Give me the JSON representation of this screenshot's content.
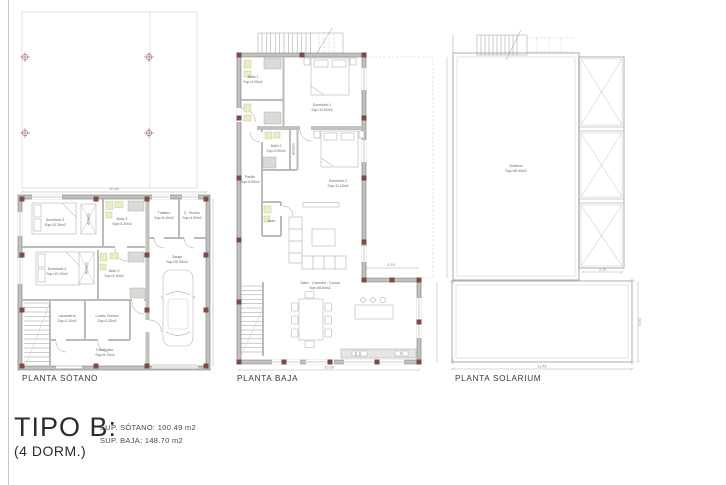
{
  "colors": {
    "wall_fill": "#c3c1bf",
    "wall_edge": "#7a7876",
    "column_block": "#7d4a45",
    "fixture_highlight": "#e9eec9",
    "shower_gray": "#dcdad7",
    "background": "#ffffff"
  },
  "title_block": {
    "type_label": "TIPO B:",
    "dorm_label": "(4 DORM.)",
    "sup_sotano": "SUP. SÓTANO: 100.49 m2",
    "sup_baja": "SUP. BAJA: 148.70 m2"
  },
  "plans": {
    "sotano": {
      "label": "PLANTA SÓTANO",
      "dims": {
        "width": "10.50"
      },
      "rooms": {
        "dorm3": {
          "name": "Dormitorio 3",
          "sup": "Sup=10.35m2"
        },
        "dorm4": {
          "name": "Dormitorio 4",
          "sup": "Sup=10.20m2"
        },
        "bano2": {
          "name": "Baño 2",
          "sup": "Sup=4.30m2"
        },
        "bano3": {
          "name": "Baño 3",
          "sup": "Sup=4.15m2"
        },
        "armario1": {
          "name": "Armario"
        },
        "armario2": {
          "name": "Armario"
        },
        "trastero": {
          "name": "Trastero",
          "sup": "Sup=5.10m2"
        },
        "tecnico": {
          "name": "C. Técnico",
          "sup": "Sup=4.90m2"
        },
        "garaje": {
          "name": "Garaje",
          "sup": "Sup=28.35m2"
        },
        "lavanderia": {
          "name": "Lavandería",
          "sup": "Sup=3.10m2"
        },
        "cuarto_tecnico": {
          "name": "Cuarto Técnico",
          "sup": "Sup=3.25m2"
        },
        "distribuidor": {
          "name": "Distribuidor",
          "sup": "Sup=6.10m2"
        }
      }
    },
    "baja": {
      "label": "PLANTA BAJA",
      "dims": {
        "terrace": "3.10",
        "width": "10.50"
      },
      "rooms": {
        "bano1": {
          "name": "Baño 1",
          "sup": "Sup=4.05m2"
        },
        "bano2": {
          "name": "Baño 2",
          "sup": "Sup=3.90m2"
        },
        "aseo": {
          "name": "Aseo"
        },
        "armario": {
          "name": "Armario"
        },
        "pasillo": {
          "name": "Pasillo",
          "sup": "Sup=6.95m2"
        },
        "dorm1": {
          "name": "Dormitorio 1",
          "sup": "Sup=12.60m2"
        },
        "dorm2": {
          "name": "Dormitorio 2",
          "sup": "Sup=11.15m2"
        },
        "salon": {
          "name": "Salón - Comedor - Cocina",
          "sup": "Sup=48.50m2"
        }
      }
    },
    "solarium": {
      "label": "PLANTA SOLARIUM",
      "dims": {
        "panel": "3.10",
        "width": "11.45",
        "height": "5.00"
      },
      "rooms": {
        "solarium": {
          "name": "Solárium",
          "sup": "Sup=98.40m2"
        }
      }
    }
  }
}
